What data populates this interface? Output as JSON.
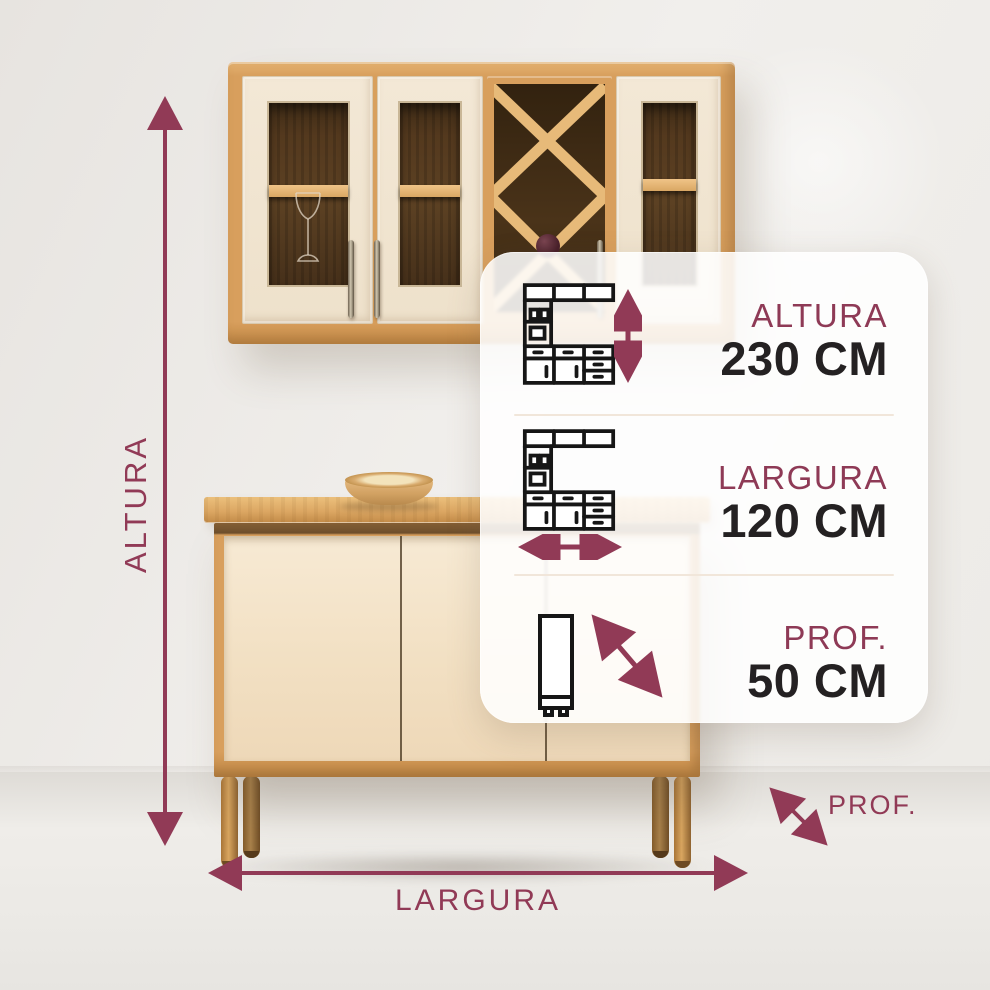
{
  "colors": {
    "accent": "#8E3A56",
    "value_text": "#242122",
    "card_background": "rgba(255,255,255,0.87)",
    "wood_oak": "#D89F5D",
    "door_cream": "#F1E4D0"
  },
  "axes": {
    "height_label": "ALTURA",
    "width_label": "LARGURA",
    "depth_label": "PROF."
  },
  "card": {
    "rows": [
      {
        "label": "ALTURA",
        "value": "230 CM",
        "icon": "kitchen-set-height-arrow-icon"
      },
      {
        "label": "LARGURA",
        "value": "120 CM",
        "icon": "kitchen-set-width-arrow-icon"
      },
      {
        "label": "PROF.",
        "value": "50 CM",
        "icon": "cabinet-side-depth-arrow-icon"
      }
    ]
  },
  "icons": {
    "kitchen_set": "kitchen-cabinet-set-line-icon",
    "tall_cabinet": "tall-cabinet-side-line-icon",
    "arrows": "double-headed-dimension-arrow"
  }
}
